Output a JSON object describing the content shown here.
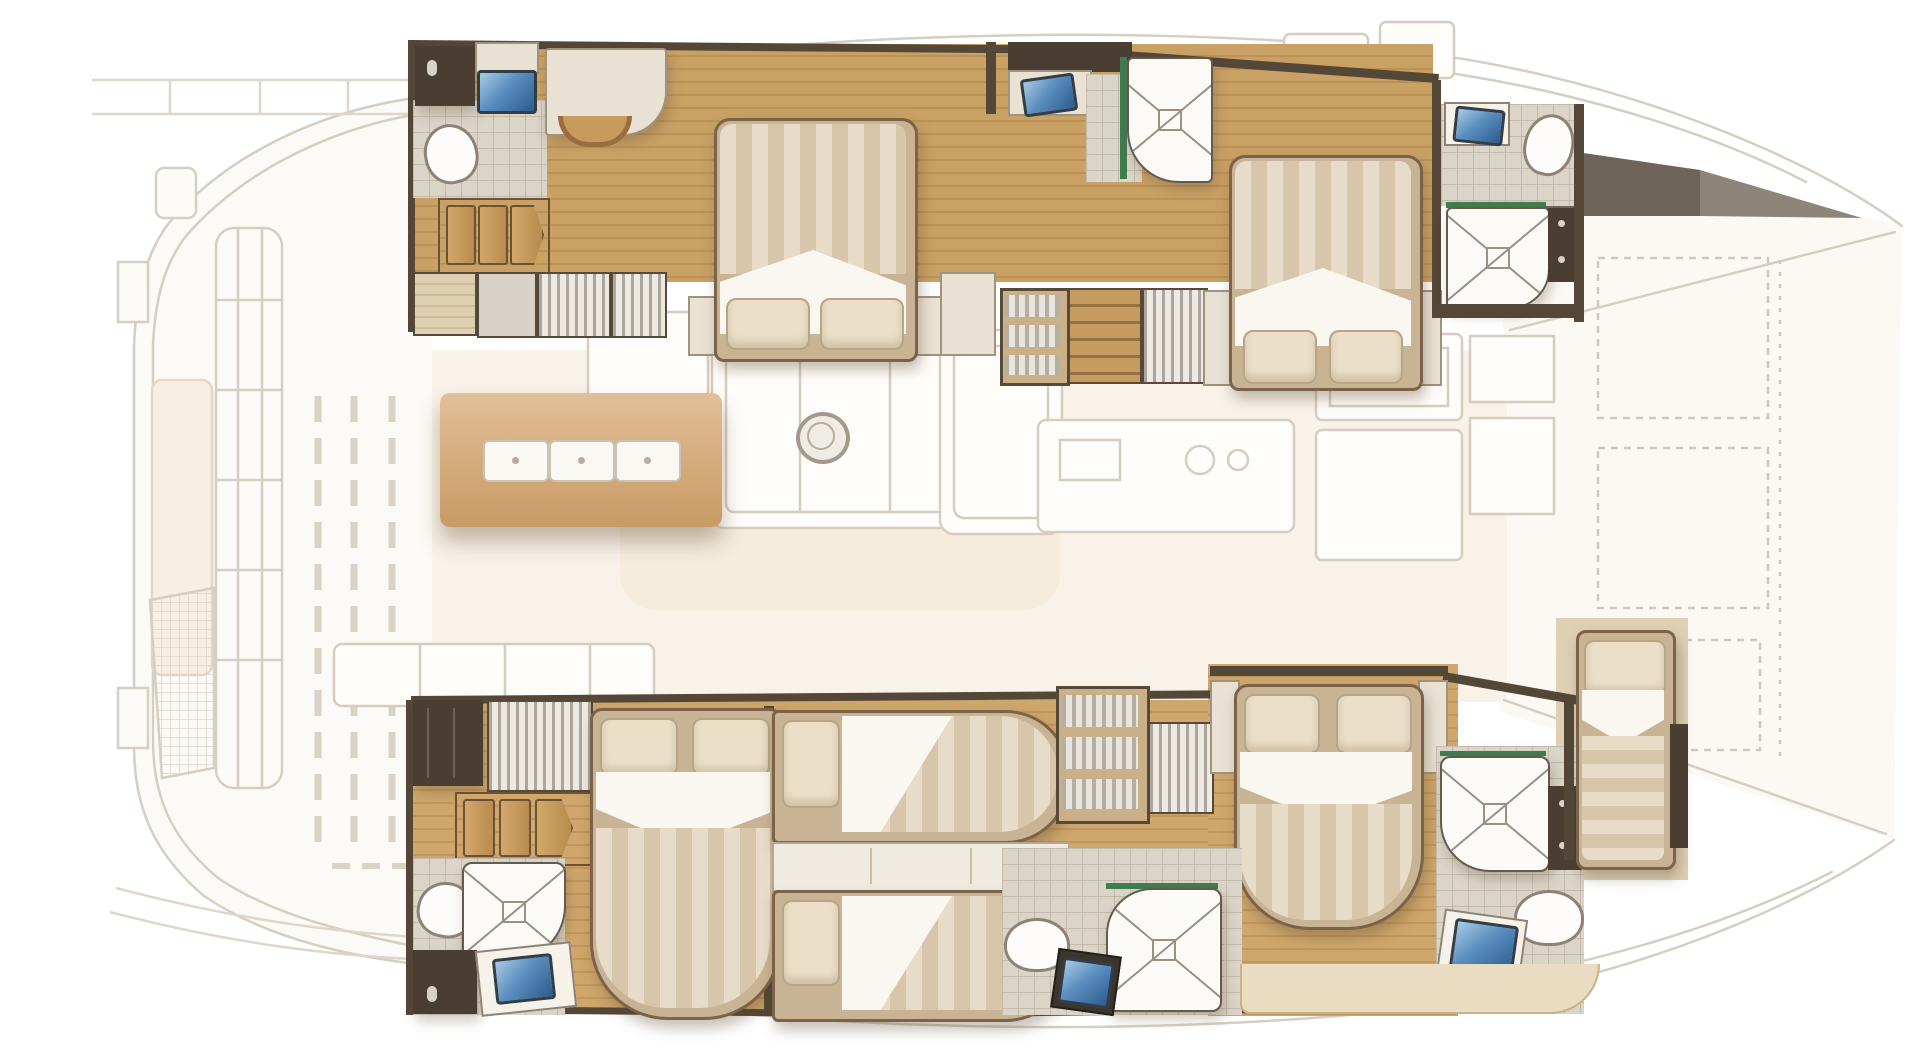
{
  "plan": {
    "type": "yacht-floor-plan",
    "vessel": "catamaran",
    "view": "overhead interior deck plan, bows to the right, upper-deck areas drawn faded",
    "inventory": {
      "double_beds": 4,
      "single_berths": 3,
      "bathrooms": 6,
      "showers": 5,
      "toilets": 5,
      "washbasins": 6,
      "wardrobes": 6,
      "bookshelves": 2,
      "salon_table_place_settings": 3
    },
    "rooms": [
      {
        "id": "port-aft-cabin",
        "name": "Port aft guest cabin"
      },
      {
        "id": "port-aft-wc",
        "name": "Port aft WC / washroom"
      },
      {
        "id": "port-mid-head",
        "name": "Port midship bathroom"
      },
      {
        "id": "port-fwd-cabin",
        "name": "Port forward guest cabin"
      },
      {
        "id": "port-fwd-head",
        "name": "Port forward bathroom"
      },
      {
        "id": "stbd-aft-cabin",
        "name": "Starboard aft guest cabin"
      },
      {
        "id": "stbd-aft-head",
        "name": "Starboard aft bathroom"
      },
      {
        "id": "stbd-bunk-cabin",
        "name": "Starboard twin-berth cabin"
      },
      {
        "id": "stbd-mid-head",
        "name": "Starboard midship bathroom"
      },
      {
        "id": "stbd-fwd-cabin",
        "name": "Starboard forward guest cabin"
      },
      {
        "id": "stbd-fwd-head",
        "name": "Starboard forward bathroom"
      },
      {
        "id": "forepeak-berth",
        "name": "Forepeak crew berth"
      },
      {
        "id": "salon",
        "name": "Bridgedeck salon (upper level, faded)"
      },
      {
        "id": "aft-deck",
        "name": "Aft deck / cockpit (faded)"
      },
      {
        "id": "foredeck",
        "name": "Foredeck (faded)"
      }
    ],
    "palette": {
      "wood_floor": "#c9a165",
      "wood_floor_line": "#bb9254",
      "wall_dark": "#4a3e33",
      "trim_wood": "#7b6248",
      "mattress_light": "#e8dcc8",
      "mattress_dark": "#d8c6aa",
      "duvet_white": "#faf7f0",
      "pillow": "#ecdfc8",
      "tile_floor": "#dbd4c8",
      "fixture_white": "#fdfcfa",
      "sink_blue": "#4679ad",
      "accent_green": "#3f7d4e",
      "faded_line": "#d5cec3",
      "faded_fill": "#fbf8f3",
      "table_wood": "#d4a876",
      "books_tan": "#c59b60"
    }
  }
}
